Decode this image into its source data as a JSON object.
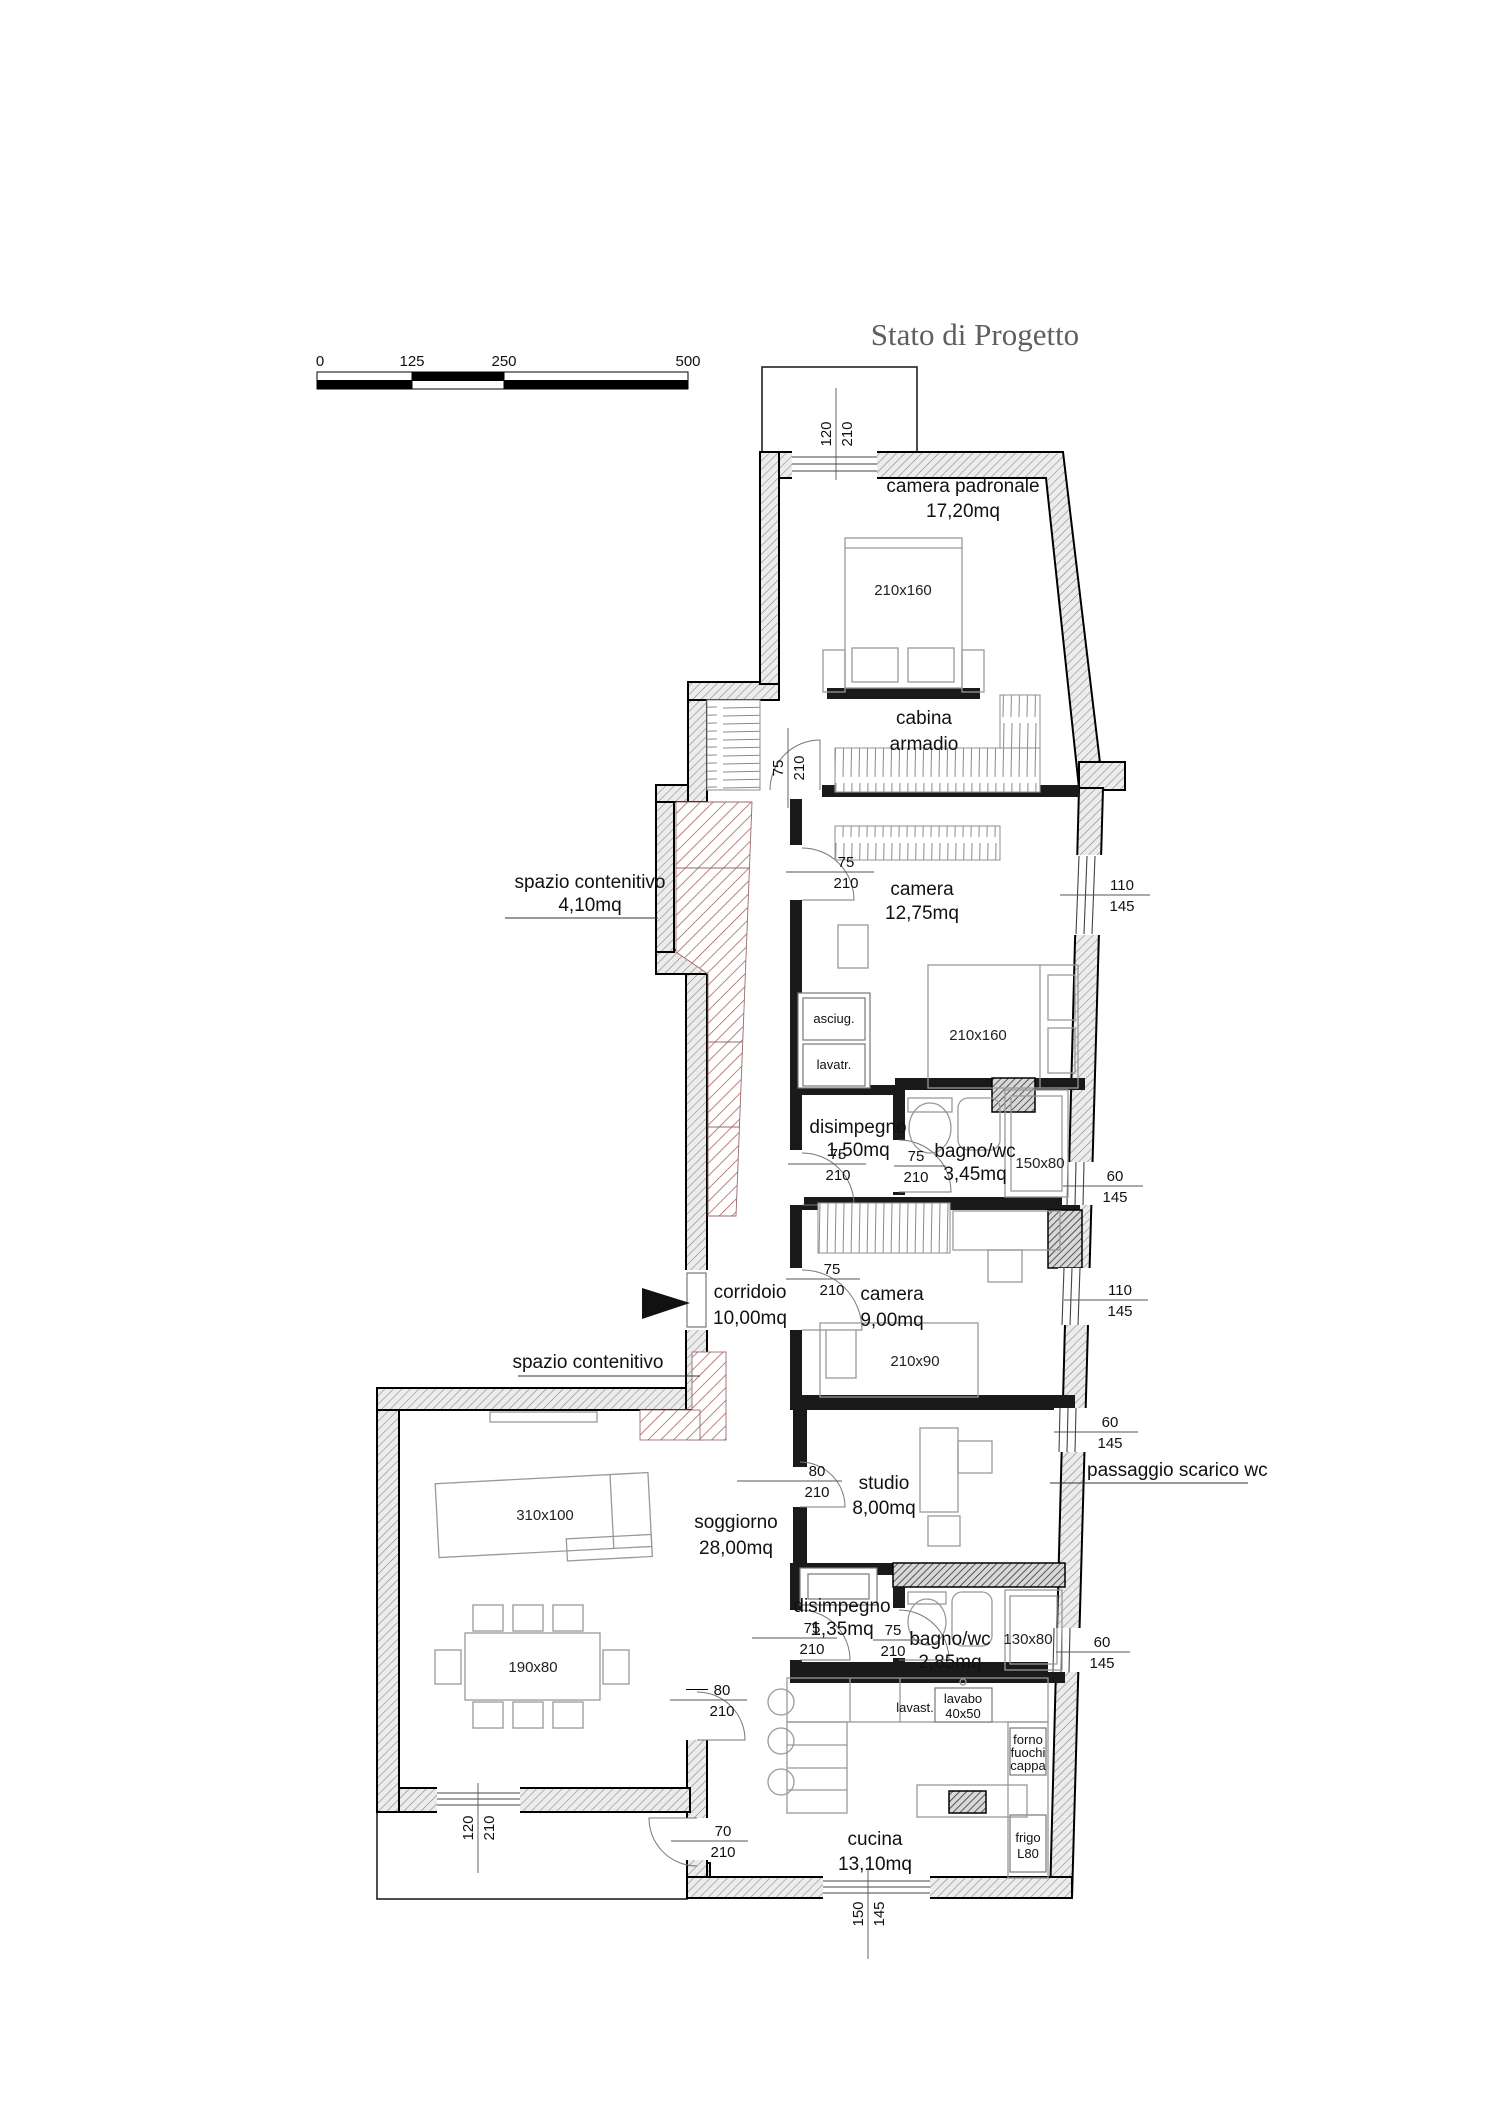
{
  "title": "Stato di Progetto",
  "scale_bar": {
    "t0": "0",
    "t125": "125",
    "t250": "250",
    "t500": "500"
  },
  "rooms": {
    "cp_name": "camera padronale",
    "cp_area": "17,20mq",
    "cab1": "cabina",
    "cab2": "armadio",
    "c1_name": "camera",
    "c1_area": "12,75mq",
    "d1_name": "disimpegno",
    "d1_area": "1,50mq",
    "b1_name": "bagno/wc",
    "b1_area": "3,45mq",
    "corr_name": "corridoio",
    "corr_area": "10,00mq",
    "c2_name": "camera",
    "c2_area": "9,00mq",
    "studio_name": "studio",
    "studio_area": "8,00mq",
    "sog_name": "soggiorno",
    "sog_area": "28,00mq",
    "d2_name": "disimpegno",
    "d2_area": "1,35mq",
    "b2_name": "bagno/wc",
    "b2_area": "2,85mq",
    "cuc_name": "cucina",
    "cuc_area": "13,10mq",
    "sp1_name": "spazio contenitivo",
    "sp1_area": "4,10mq",
    "sp2_name": "spazio contenitivo"
  },
  "annotations": {
    "passaggio": "passaggio scarico wc"
  },
  "furniture": {
    "bed_large": "210x160",
    "bed_single": "210x90",
    "sofa": "310x100",
    "table": "190x80",
    "shower_large": "150x80",
    "shower_small": "130x80",
    "asciugatrice": "asciug.",
    "lavatrice": "lavatr.",
    "lavastoviglie": "lavast.",
    "lavabo": "lavabo",
    "lavabo_size": "40x50",
    "forno": "forno",
    "fuochi": "fuochi",
    "cappa": "cappa",
    "frigo": "frigo",
    "frigo_size": "L80"
  },
  "dims": {
    "n60": "60",
    "n70": "70",
    "n75": "75",
    "n80": "80",
    "n110": "110",
    "n120": "120",
    "n145": "145",
    "n150": "150",
    "n210": "210"
  }
}
